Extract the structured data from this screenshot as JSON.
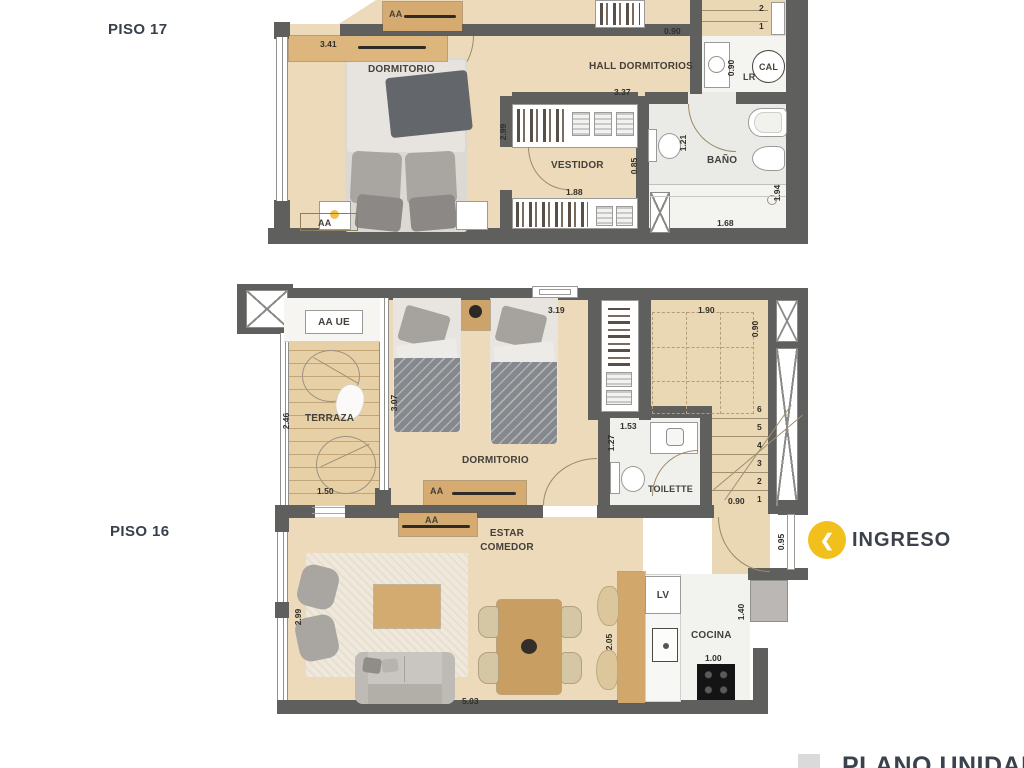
{
  "titles": {
    "piso17": "PISO 17",
    "piso16": "PISO 16",
    "footer": "PLANO UNIDAD"
  },
  "ingreso": {
    "label": "INGRESO",
    "icon_glyph": "❮",
    "circle_color": "#F2C01C"
  },
  "p17": {
    "dormitorio": "DORMITORIO",
    "hall": "HALL DORMITORIOS",
    "vestidor": "VESTIDOR",
    "bano": "BAÑO",
    "cal": "CAL",
    "lr": "LR",
    "aa_top": "AA",
    "aa_bed": "AA",
    "dim_341": "3.41",
    "dim_090_hall": "0.90",
    "dim_337": "3.37",
    "dim_299": "2.99",
    "dim_085": "0.85",
    "dim_188": "1.88",
    "dim_121": "1.21",
    "dim_194": "1.94",
    "dim_168": "1.68",
    "dim_090_cal": "0.90",
    "step_2": "2",
    "step_1": "1"
  },
  "p16": {
    "terraza": "TERRAZA",
    "dormitorio": "DORMITORIO",
    "toilette": "TOILETTE",
    "estar": "ESTAR",
    "comedor": "COMEDOR",
    "cocina": "COCINA",
    "aa_ue": "AA UE",
    "aa_1": "AA",
    "aa_2": "AA",
    "lv": "LV",
    "dim_319": "3.19",
    "dim_190": "1.90",
    "dim_090_shaft": "0.90",
    "dim_307": "3.07",
    "dim_246": "2.46",
    "dim_150": "1.50",
    "dim_153": "1.53",
    "dim_127": "1.27",
    "dim_090_stair": "0.90",
    "dim_095": "0.95",
    "dim_299": "2.99",
    "dim_503": "5.03",
    "dim_205": "2.05",
    "dim_100": "1.00",
    "dim_140": "1.40",
    "steps": [
      "1",
      "2",
      "3",
      "4",
      "5",
      "6"
    ]
  }
}
